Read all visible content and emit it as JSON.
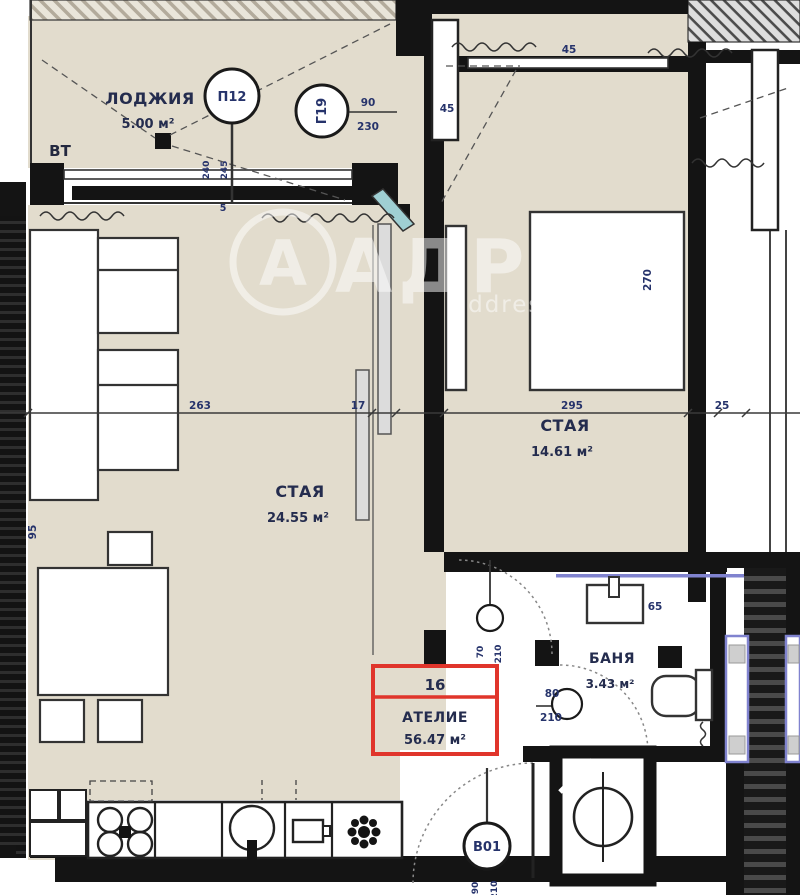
{
  "watermark": {
    "letter": "А",
    "brand": "АДРЕС",
    "site": "address.bg"
  },
  "rooms": {
    "loggia": {
      "name": "ЛОДЖИЯ",
      "area": "5.00 м²"
    },
    "living": {
      "name": "СТАЯ",
      "area": "24.55 м²"
    },
    "bedroom": {
      "name": "СТАЯ",
      "area": "14.61 м²"
    },
    "bath": {
      "name": "БАНЯ",
      "area": "3.43 м²"
    }
  },
  "unit_box": {
    "number": "16",
    "type": "АТЕЛИЕ",
    "area": "56.47 м²"
  },
  "balloons": {
    "window": {
      "id": "П12",
      "dim_a": "240",
      "dim_b": "245"
    },
    "loggia_door": {
      "id": "Г19",
      "width": "90",
      "height": "230"
    },
    "hall_door": {
      "dim_a": "70",
      "dim_b": "210"
    },
    "bath_door": {
      "width": "80",
      "height": "210"
    },
    "entry_door": {
      "id": "В01",
      "dim_a": "90",
      "dim_b": "210"
    }
  },
  "dimensions": {
    "living_width": "263",
    "partition": "17",
    "bedroom_width": "295",
    "wall": "25",
    "left_height": "95",
    "bedroom_height": "270",
    "top_mark": "45",
    "entry_mark": "45",
    "sill_mark": "5",
    "sink_mark": "65"
  },
  "misc": {
    "vt": "ВТ"
  },
  "colors": {
    "floor_beige": "#e2dccd",
    "wall_black": "#141414",
    "annotation_red": "#e0352b",
    "adjacent_purple": "#8083cf",
    "glass_teal": "#9fcfd3",
    "label_navy": "#26336b"
  }
}
